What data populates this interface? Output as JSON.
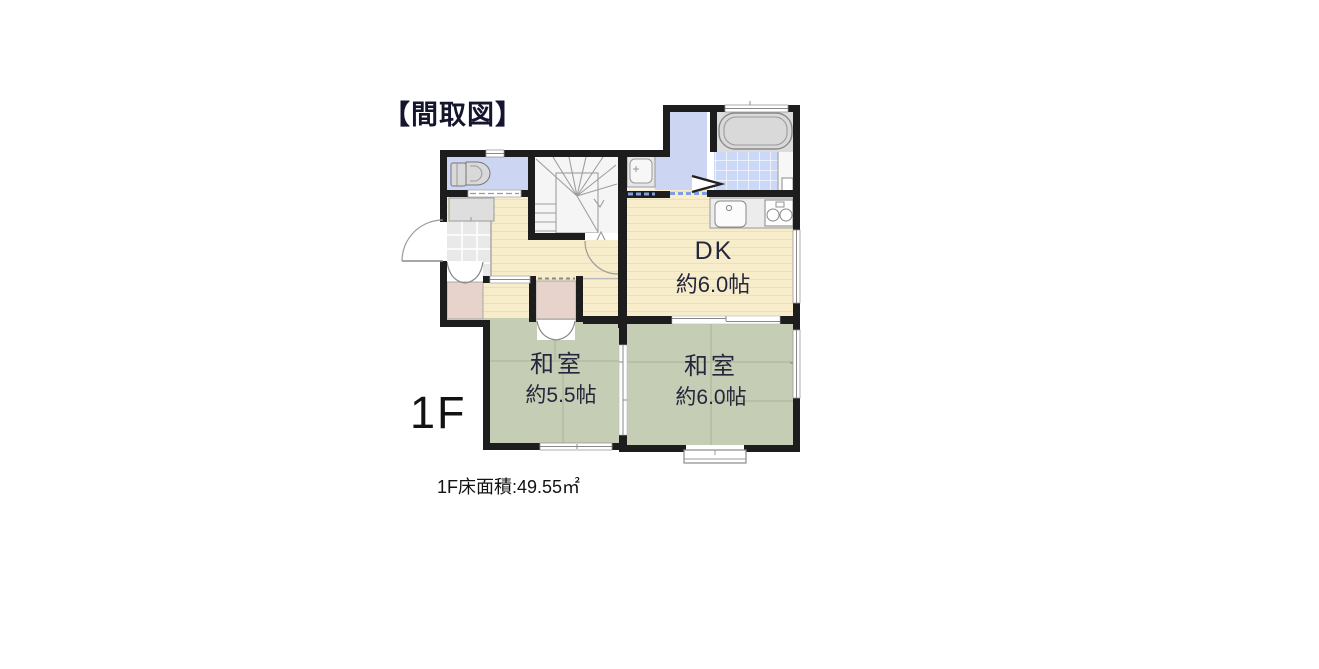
{
  "title": "【間取図】",
  "floor": {
    "label": "1F",
    "area_note": "1F床面積:49.55㎡"
  },
  "rooms": {
    "dk": {
      "name": "DK",
      "size": "約6.0帖"
    },
    "washitsu_small": {
      "name": "和室",
      "size": "約5.5帖"
    },
    "washitsu_large": {
      "name": "和室",
      "size": "約6.0帖"
    }
  },
  "fixtures": [
    "toilet",
    "staircase",
    "washbasin",
    "bathtub",
    "bath-tile-floor",
    "kitchen-sink",
    "gas-stove",
    "shoe-cabinet",
    "entrance-door",
    "closet-bifold-doors",
    "sliding-doors",
    "bay-window"
  ],
  "colors": {
    "wall": "#1d1d1d",
    "water_area_blue": "#ccd5f1",
    "bath_tile_blue": "#ccd8f7",
    "flooring_beige": "#f7edca",
    "flooring_stripe": "#eee0b5",
    "tatami_green": "#c5ceb5",
    "closet_pink": "#e7d3cb",
    "entrance_tile_gray": "#e9e9e9",
    "bath_gray": "#dcdcdc",
    "text": "#1e1e32"
  }
}
